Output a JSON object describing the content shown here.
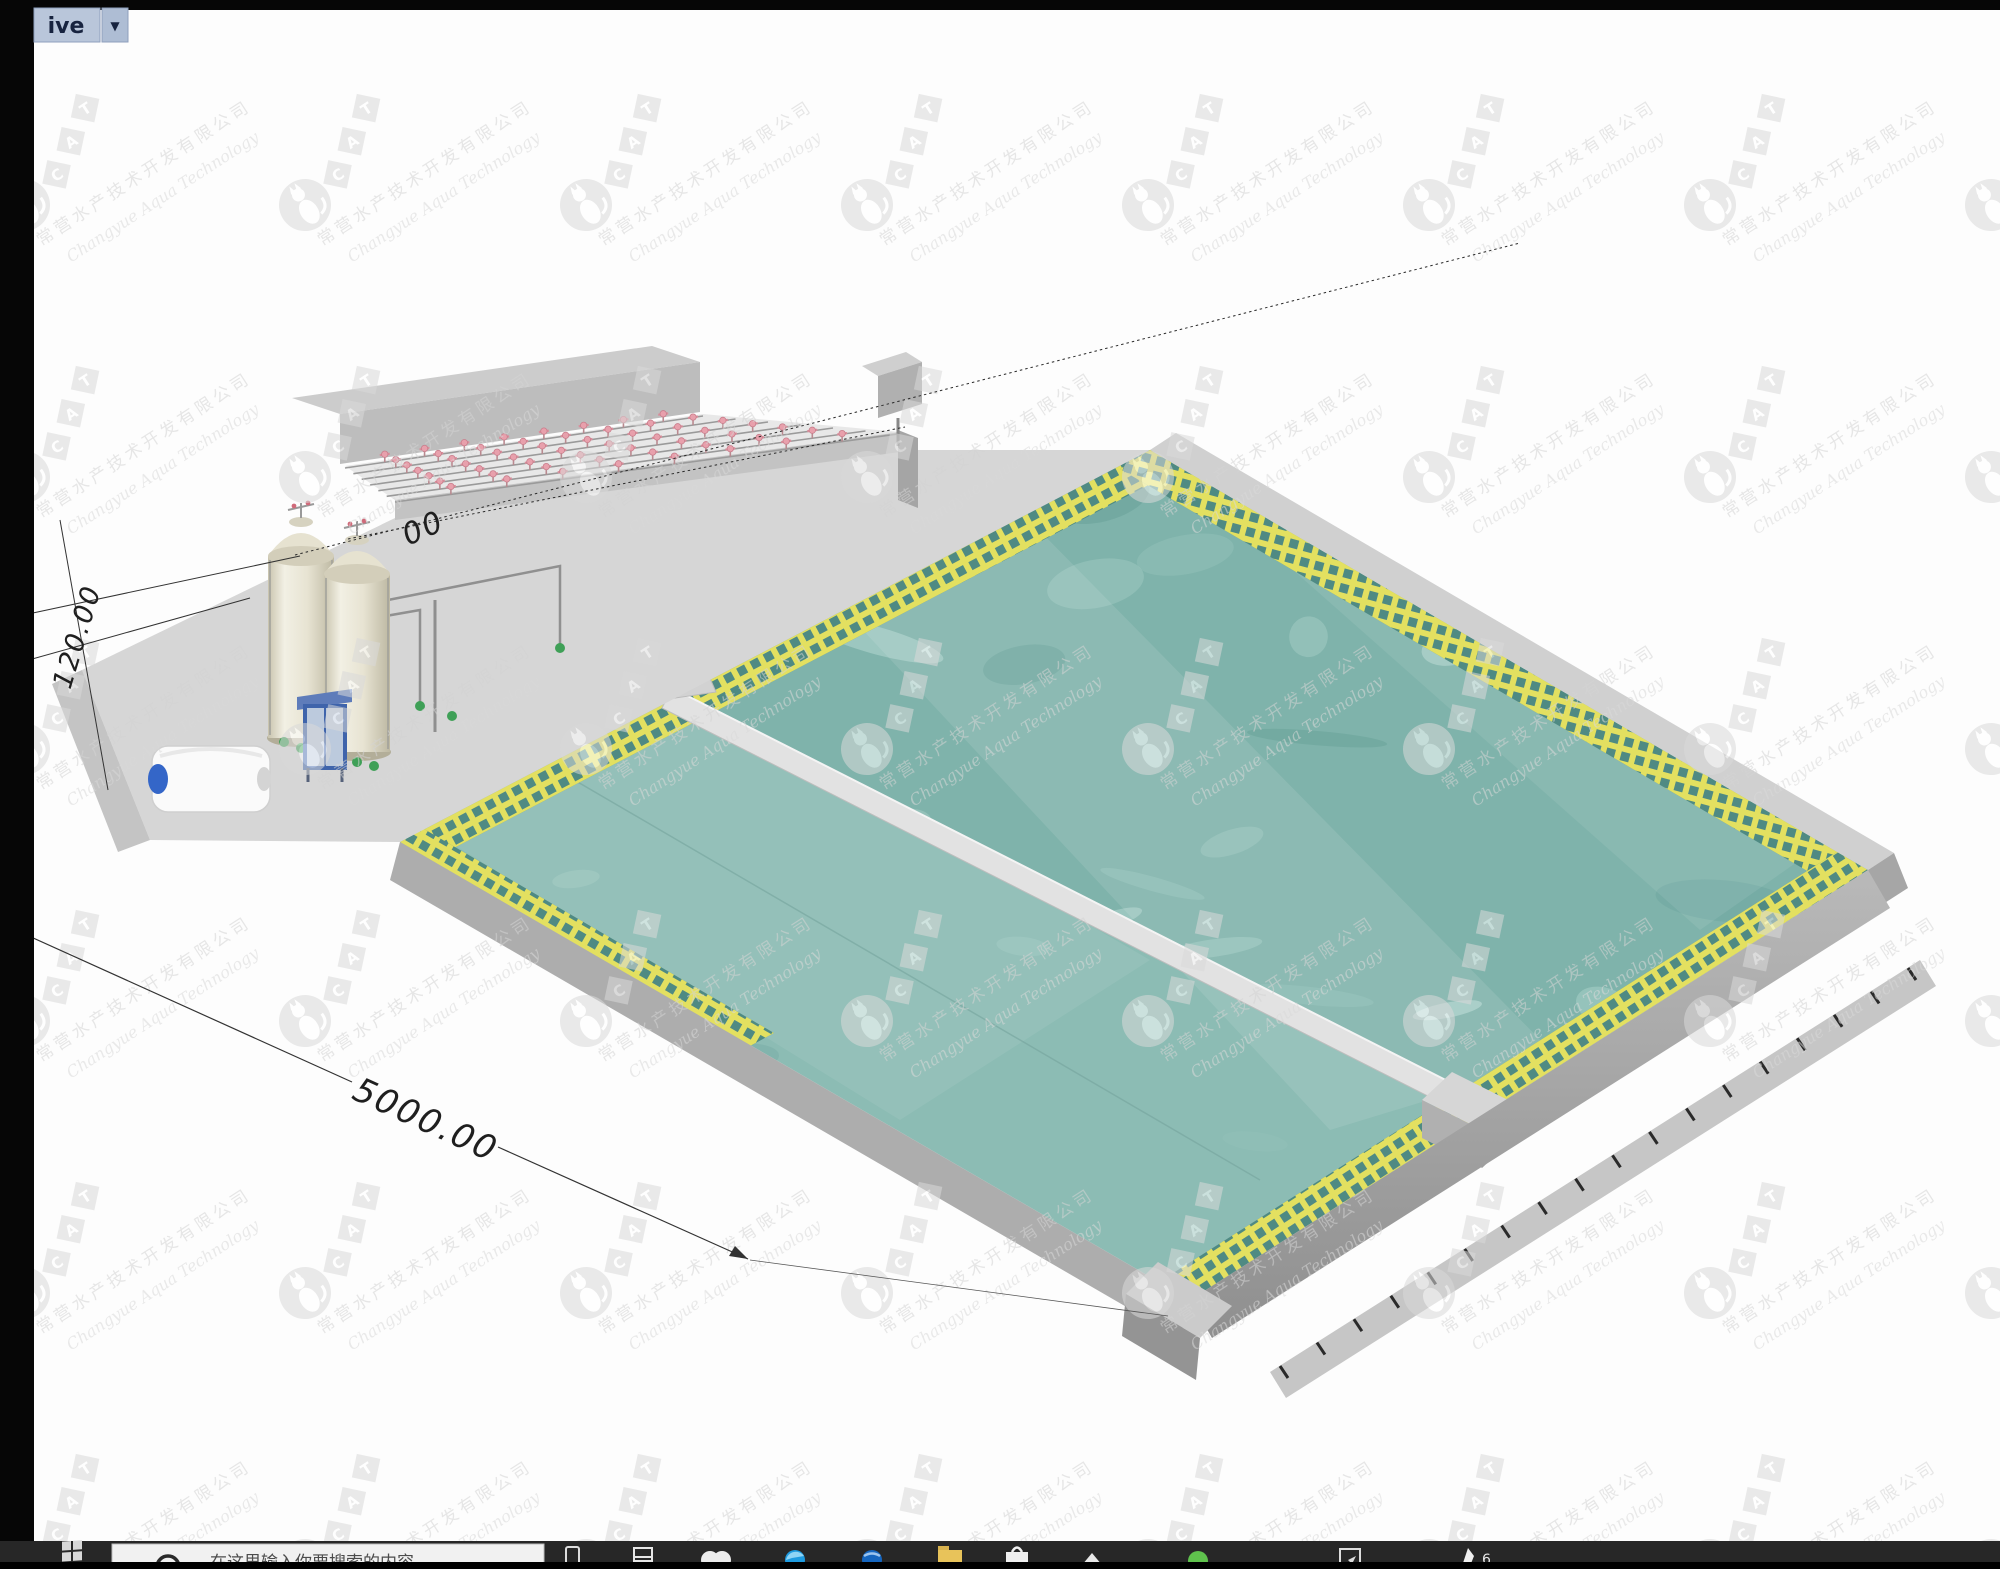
{
  "window": {
    "title_button": {
      "label": "ive",
      "dropdown_glyph": "▼"
    }
  },
  "canvas": {
    "dimensions": {
      "length": "5000.00",
      "height": "120.00",
      "width_partial": "00"
    },
    "watermark": {
      "letters": [
        "C",
        "A",
        "T"
      ],
      "company_cn": "常营水产技术开发有限公司",
      "company_en": "Changyue Aqua Technology"
    },
    "model": {
      "water_color": "#7fb3ab",
      "water_light_patch": "#a6cec6",
      "grating_color": "#e3e060",
      "concrete_color": "#c9c9c9",
      "divider_color": "#e2e2e2",
      "sprinkler_color": "#e8a0ac",
      "tank_color": "#eae6d6",
      "valve_color": "#3fa057",
      "gate_color": "#4a6fb5",
      "pump_cap_color": "#3466c8"
    }
  },
  "taskbar": {
    "search": {
      "placeholder": "在这里输入你要搜索的内容"
    },
    "badge": "6",
    "icons": [
      {
        "name": "windows-start"
      },
      {
        "name": "search-box"
      },
      {
        "name": "device"
      },
      {
        "name": "task-view"
      },
      {
        "name": "white-app"
      },
      {
        "name": "edge-browser"
      },
      {
        "name": "blue-circle-app"
      },
      {
        "name": "file-explorer"
      },
      {
        "name": "store"
      },
      {
        "name": "up-arrow"
      },
      {
        "name": "green-messenger"
      },
      {
        "name": "snip-tool"
      },
      {
        "name": "annotate-app"
      }
    ]
  }
}
